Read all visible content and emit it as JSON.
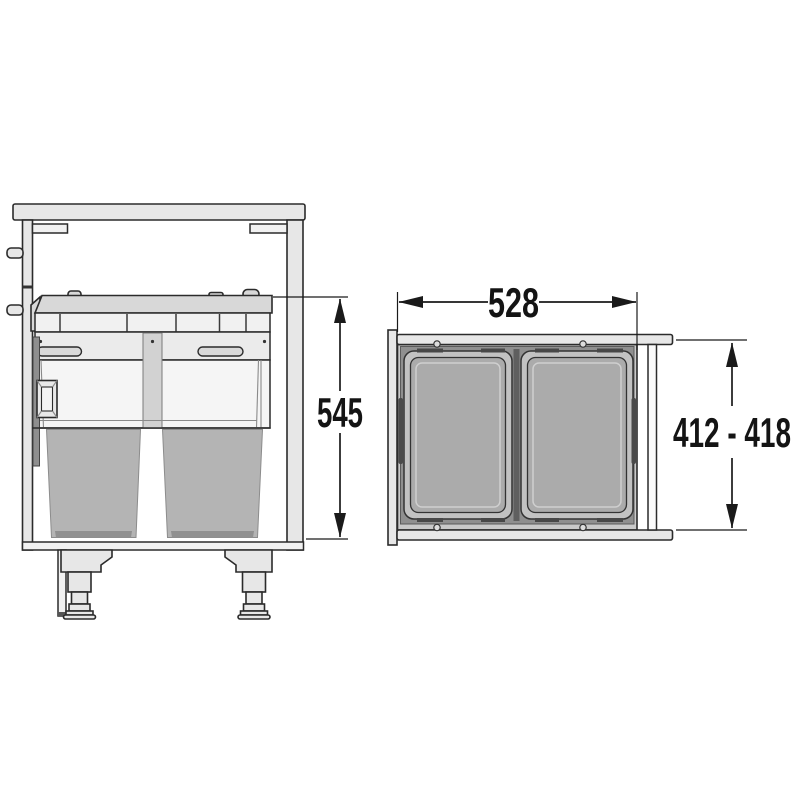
{
  "diagram": {
    "dimensions": {
      "front_height": "545",
      "top_width": "528",
      "top_depth": "412 - 418"
    },
    "colors": {
      "outline": "#2b2b2b",
      "dimension_line": "#1a1a1a",
      "cabinet_panel": "#e7e7e7",
      "pullout_lid": "#d8d8d8",
      "bin_top_view": "#ababab",
      "bucket_front_view": "#b4b4b4",
      "frame_band": "#8f8f8f",
      "background": "#ffffff"
    }
  }
}
